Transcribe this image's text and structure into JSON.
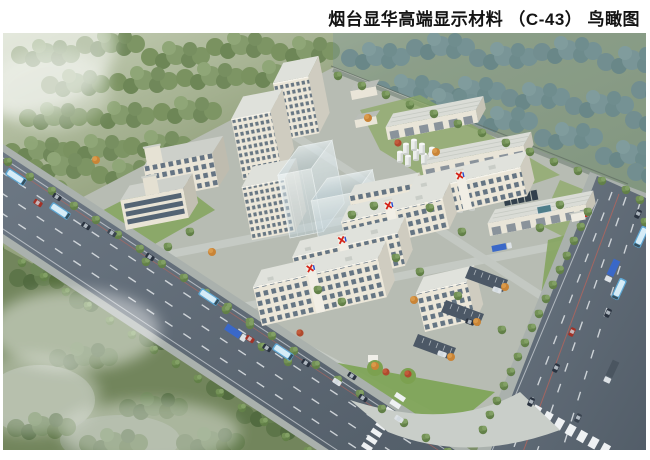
{
  "header": {
    "title": "烟台显华高端显示材料 （C-43） 鸟瞰图"
  },
  "branding": {
    "logo_icon": "xianhua-x-logo",
    "logo_red": "#d42318",
    "logo_blue": "#2a4fd0"
  },
  "palette": {
    "page_background": "#ffffff",
    "title_text": "#141414",
    "forest_green": "#7e9468",
    "forest_blue_haze": "#7895a0",
    "campus_ground": "#b7bcb3",
    "lawn_green": "#7fa257",
    "road_asphalt": "#5f6a75",
    "building_facade": "#ece7d9",
    "building_window": "#57687a",
    "glass_massing": "#cfe1ea",
    "bus_blue": "#5fa8d4",
    "truck_blue": "#3a68c8",
    "accent_tree_orange": "#cf8a3a",
    "accent_tree_red": "#b84a2e"
  }
}
